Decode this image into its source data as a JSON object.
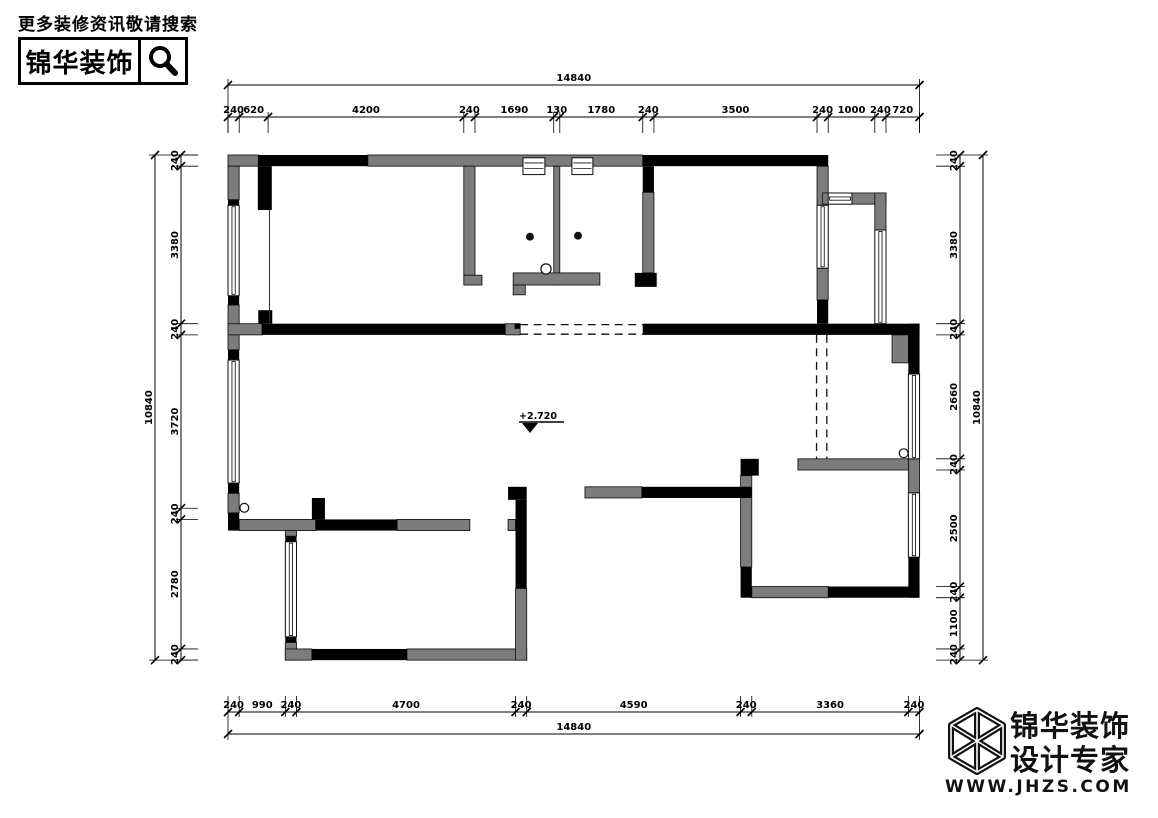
{
  "header": {
    "tagline": "更多装修资讯敬请搜索",
    "logo_text": "锦华装饰",
    "search_icon": "magnifier"
  },
  "footer": {
    "brand_line1": "锦华装饰",
    "brand_line2": "设计专家",
    "website": "WWW.JHZS.COM",
    "brand_icon": "wireframe-cube"
  },
  "plan": {
    "level_label": "+2.720",
    "dimensions": {
      "top": {
        "total": "14840",
        "segments": [
          240,
          620,
          4200,
          240,
          1690,
          130,
          1780,
          240,
          3500,
          240,
          1000,
          240,
          720
        ]
      },
      "bottom": {
        "total": "14840",
        "segments": [
          240,
          990,
          240,
          4700,
          240,
          4590,
          240,
          3360,
          240
        ]
      },
      "left": {
        "total": "10840",
        "segments": [
          240,
          3380,
          240,
          3720,
          240,
          2780,
          240
        ]
      },
      "right": {
        "total": "10840",
        "segments": [
          240,
          3380,
          240,
          2660,
          240,
          2500,
          240,
          1100,
          240
        ]
      }
    },
    "colors": {
      "wall_existing": "#7c7c7c",
      "wall_structural": "#000000",
      "background": "#ffffff",
      "line": "#000000"
    },
    "symbols": [
      "window",
      "flue-vent",
      "removed-wall-dashed",
      "floor-drain",
      "level-marker"
    ]
  }
}
